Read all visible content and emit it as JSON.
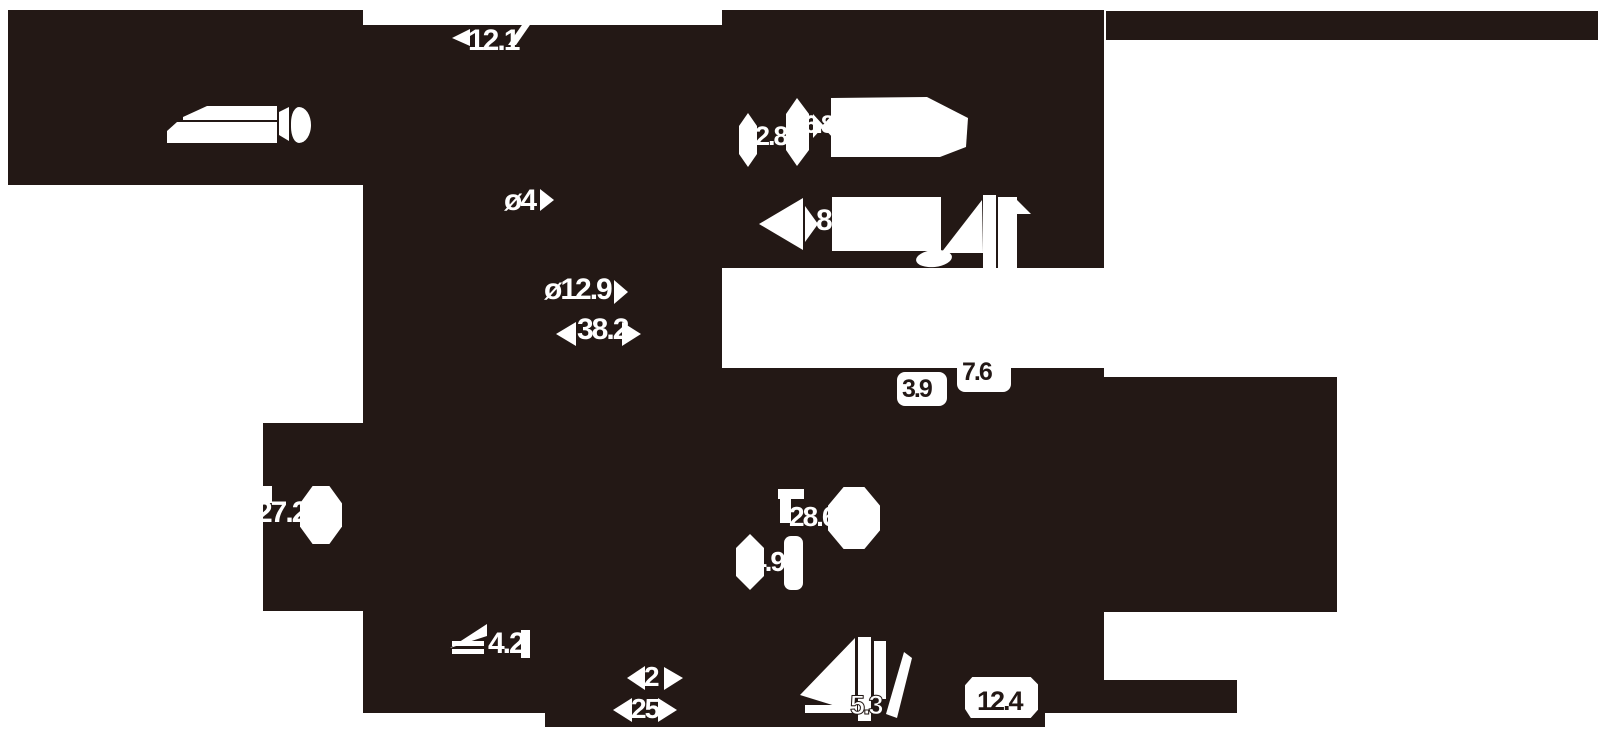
{
  "title": "earphone-product-dimension-diagram",
  "colors": {
    "ink": "#231815",
    "paper": "#ffffff"
  },
  "dims": {
    "top_width": "12.1",
    "phi4": "ø4",
    "phi12_9": "ø12.9",
    "len38_2": "38.2",
    "w2_8": "2.8",
    "w6_8": "6.8",
    "w8": "8",
    "w3_9": "3.9",
    "w7_6": "7.6",
    "w27_2": "27.2",
    "w28_6": "28.6",
    "w4_9": "4.9",
    "w4_2": "4.2",
    "w2": "2",
    "w25": "25",
    "w5_3": "5.3",
    "w12_4": "12.4"
  }
}
